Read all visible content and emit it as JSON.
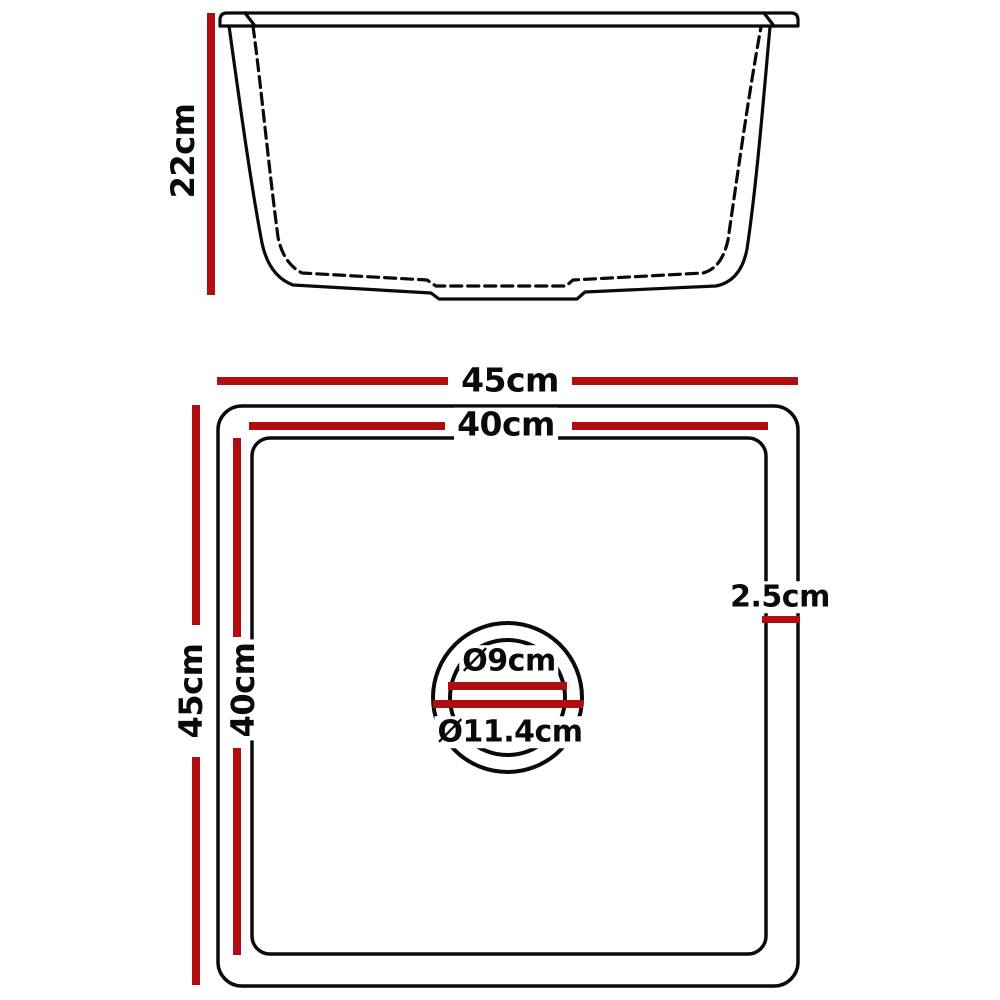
{
  "colors": {
    "dimension_red": "#b00d10",
    "line": "#0a0a0a",
    "background": "#ffffff"
  },
  "side_view": {
    "height_label": "22cm"
  },
  "top_view": {
    "outer_width_label": "45cm",
    "inner_width_label": "40cm",
    "outer_height_label": "45cm",
    "inner_height_label": "40cm",
    "edge_thickness_label": "2.5cm",
    "drain_inner_diameter_label": "Ø9cm",
    "drain_outer_diameter_label": "Ø11.4cm"
  }
}
